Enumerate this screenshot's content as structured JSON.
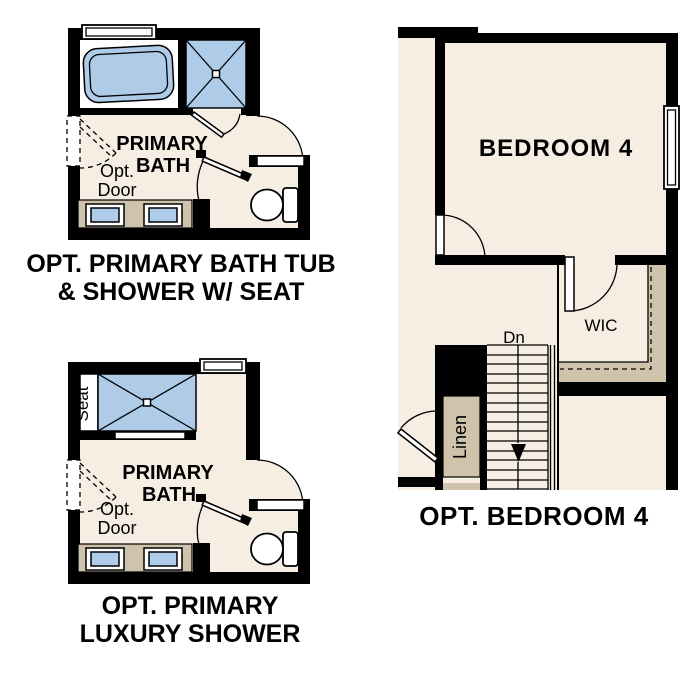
{
  "colors": {
    "floor": "#f7eee3",
    "fixture_blue": "#aecbe8",
    "tan": "#cfc4ab",
    "wall": "#000000",
    "background": "#ffffff"
  },
  "plans": {
    "bath_tub_shower": {
      "title_line1": "OPT. PRIMARY BATH TUB",
      "title_line2": "& SHOWER W/ SEAT",
      "room_label_line1": "PRIMARY",
      "room_label_line2": "BATH",
      "opt_door_line1": "Opt.",
      "opt_door_line2": "Door"
    },
    "luxury_shower": {
      "title_line1": "OPT. PRIMARY",
      "title_line2": "LUXURY SHOWER",
      "room_label_line1": "PRIMARY",
      "room_label_line2": "BATH",
      "opt_door_line1": "Opt.",
      "opt_door_line2": "Door",
      "seat_label": "Seat"
    },
    "bedroom4": {
      "title": "OPT. BEDROOM 4",
      "room_label": "BEDROOM 4",
      "wic_label": "WIC",
      "stairs_label": "Dn",
      "linen_label": "Linen"
    }
  }
}
